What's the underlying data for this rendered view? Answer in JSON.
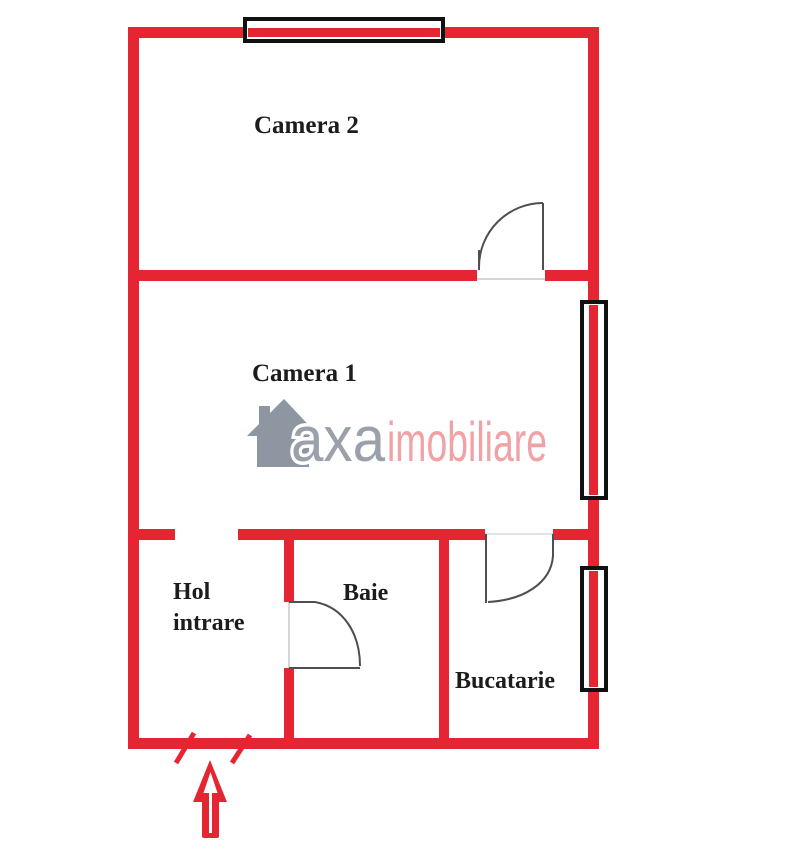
{
  "page": {
    "background": "#ffffff",
    "type_label": "apartment floor plan"
  },
  "colors": {
    "wall_red": "#e52532",
    "window_frame_black": "#111111",
    "door_line_gray": "#4f4f4f",
    "threshold_gray": "#c8c8c8",
    "label_black": "#1c1c1c",
    "logo_gray": "#949ba5",
    "logo_pink": "#f1a2a7",
    "arrow_red": "#e52532"
  },
  "floorplan": {
    "rooms": {
      "camera2": {
        "label": "Camera 2"
      },
      "camera1": {
        "label": "Camera 1"
      },
      "hol": {
        "label_line1": "Hol",
        "label_line2": "intrare"
      },
      "baie": {
        "label": "Baie"
      },
      "bucatarie": {
        "label": "Bucatarie"
      }
    },
    "features": {
      "windows": [
        "top-wall-window",
        "camera1-right-window",
        "bucatarie-right-window"
      ],
      "doors": [
        "camera2-door",
        "baie-door",
        "bucatarie-door"
      ],
      "entrance_marker": "entrance-arrow-up"
    }
  },
  "watermark": {
    "icon": "house-icon",
    "brand_primary": "axa",
    "brand_secondary": "imobiliare"
  }
}
